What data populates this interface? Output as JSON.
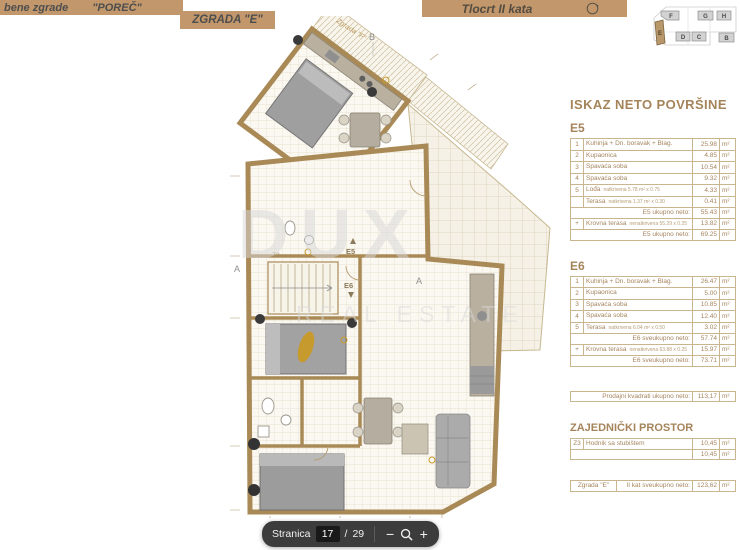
{
  "header": {
    "banner_left_text": "bene zgrade",
    "project_name": "\"POREČ\"",
    "building_name": "ZGRADA \"E\"",
    "floor_title": "Tlocrt II kata"
  },
  "site_map": {
    "buildings": [
      "F",
      "G",
      "H",
      "E",
      "D",
      "C",
      "B"
    ],
    "highlighted": "E"
  },
  "plan": {
    "labels": {
      "neighbor_building": "Zgrada \"F\"",
      "section_b": "B",
      "section_a_left": "A",
      "section_a_right": "A",
      "unit_e5": "E5",
      "unit_e6": "E6",
      "stairwell": "Z3"
    },
    "watermark": {
      "line1": "DUX",
      "line2": "REAL ESTATE"
    }
  },
  "tables": {
    "unit": "m²",
    "title": "ISKAZ NETO POVRŠINE",
    "e5": {
      "label": "E5",
      "rows": [
        {
          "num": "1",
          "name": "Kuhinja + Dn. boravak + Blag.",
          "note": "",
          "value": "25.98"
        },
        {
          "num": "2",
          "name": "Kupaonica",
          "note": "",
          "value": "4.85"
        },
        {
          "num": "3",
          "name": "Spavaća soba",
          "note": "",
          "value": "10.54"
        },
        {
          "num": "4",
          "name": "Spavaća soba",
          "note": "",
          "value": "9.32"
        },
        {
          "num": "5",
          "name": "Lođa",
          "note": "natkrivena 5.78 m² x 0.75",
          "value": "4.33"
        },
        {
          "num": "",
          "name": "Terasa",
          "note": "natkrivena 1.37 m² x 0.30",
          "value": "0.41"
        }
      ],
      "subtotal_label": "E5 ukupno neto:",
      "subtotal_value": "55.43",
      "extra_row": {
        "num": "+",
        "name": "Krovna terasa",
        "note": "nenatkrivena 55.29 x 0.25",
        "value": "13.82"
      },
      "total_label": "E5 ukupno neto:",
      "total_value": "69.25"
    },
    "e6": {
      "label": "E6",
      "rows": [
        {
          "num": "1",
          "name": "Kuhinja + Dn. boravak + Blag.",
          "note": "",
          "value": "26.47"
        },
        {
          "num": "2",
          "name": "Kupaonica",
          "note": "",
          "value": "5.00"
        },
        {
          "num": "3",
          "name": "Spavaća soba",
          "note": "",
          "value": "10.85"
        },
        {
          "num": "4",
          "name": "Spavaća soba",
          "note": "",
          "value": "12.40"
        },
        {
          "num": "5",
          "name": "Terasa",
          "note": "natkrivena 6.04 m² x 0.50",
          "value": "3.02"
        }
      ],
      "subtotal_label": "E6 sveukupno neto:",
      "subtotal_value": "57.74",
      "extra_row": {
        "num": "+",
        "name": "Krovna terasa",
        "note": "nenatkrivena 63.88 x 0.25",
        "value": "15.97"
      },
      "total_label": "E6 sveukupno neto:",
      "total_value": "73.71"
    },
    "sales_summary": {
      "label": "Prodajni kvadrati ukupno neto:",
      "value": "113,17"
    },
    "common_area": {
      "title": "ZAJEDNIČKI PROSTOR",
      "row": {
        "num": "Z3",
        "name": "Hodnik sa stubištem",
        "value": "10,45"
      },
      "total_value": "10,45"
    },
    "building_total": {
      "name": "Zgrada \"E\"",
      "label": "II kat sveukupno neto:",
      "value": "123,62"
    }
  },
  "toolbar": {
    "page_label": "Stranica",
    "page_current": "17",
    "separator": "/",
    "page_total": "29",
    "zoom_out_label": "−",
    "zoom_in_label": "+"
  },
  "colors": {
    "banner": "#c1976b",
    "table_text": "#a5855f",
    "toolbar_bg": "#3c3c3c"
  }
}
